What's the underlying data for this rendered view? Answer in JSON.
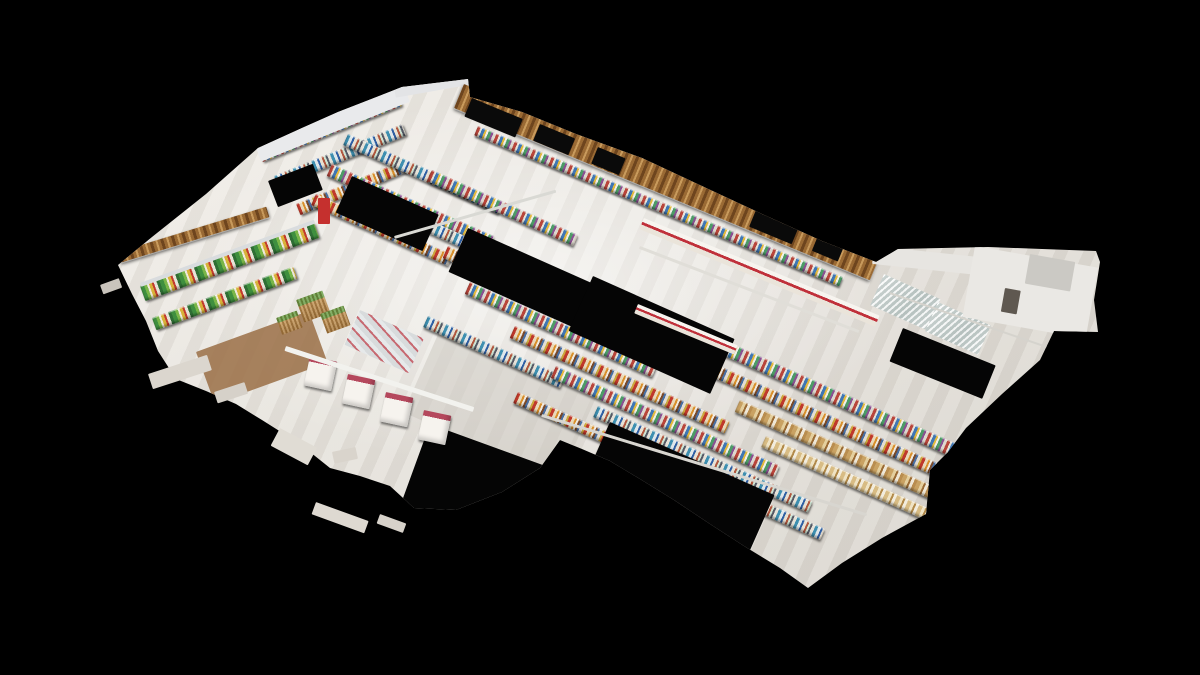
{
  "scene": {
    "palette": {
      "background": "#000000",
      "floor_hi": "#efece6",
      "floor_lo": "#dbd7d0",
      "wood_dark": "#6e451e",
      "wood_mid": "#9a6a34",
      "wood_light": "#c89a5c",
      "accent_red": "#c0303a",
      "stripe_magenta": "#b5485d",
      "void_black": "#050505",
      "wall_white": "#e9eaec",
      "rail_white": "#f2f2ee"
    },
    "outline": [
      [
        118,
        265
      ],
      [
        152,
        237
      ],
      [
        206,
        194
      ],
      [
        258,
        148
      ],
      [
        302,
        128
      ],
      [
        338,
        112
      ],
      [
        402,
        87
      ],
      [
        468,
        79
      ],
      [
        470,
        97
      ],
      [
        522,
        112
      ],
      [
        576,
        134
      ],
      [
        642,
        158
      ],
      [
        704,
        187
      ],
      [
        762,
        214
      ],
      [
        822,
        241
      ],
      [
        876,
        262
      ],
      [
        898,
        249
      ],
      [
        942,
        248
      ],
      [
        988,
        247
      ],
      [
        1042,
        249
      ],
      [
        1096,
        251
      ],
      [
        1100,
        262
      ],
      [
        1094,
        300
      ],
      [
        1098,
        332
      ],
      [
        1054,
        331
      ],
      [
        1040,
        360
      ],
      [
        1002,
        394
      ],
      [
        966,
        428
      ],
      [
        948,
        452
      ],
      [
        930,
        470
      ],
      [
        926,
        514
      ],
      [
        882,
        538
      ],
      [
        842,
        563
      ],
      [
        808,
        588
      ],
      [
        780,
        568
      ],
      [
        744,
        546
      ],
      [
        710,
        524
      ],
      [
        674,
        500
      ],
      [
        640,
        479
      ],
      [
        610,
        461
      ],
      [
        582,
        449
      ],
      [
        560,
        440
      ],
      [
        540,
        468
      ],
      [
        502,
        492
      ],
      [
        456,
        510
      ],
      [
        414,
        508
      ],
      [
        390,
        486
      ],
      [
        360,
        476
      ],
      [
        330,
        468
      ],
      [
        300,
        444
      ],
      [
        262,
        420
      ],
      [
        236,
        404
      ],
      [
        206,
        391
      ],
      [
        176,
        379
      ],
      [
        158,
        351
      ],
      [
        146,
        321
      ],
      [
        132,
        294
      ]
    ],
    "objects": [
      {
        "name": "wood-floor-patch",
        "color": "#9a6f45",
        "x": 196,
        "y": 352,
        "w": 120,
        "h": 55,
        "rot": -20,
        "op": 0.85
      },
      {
        "name": "floor-shadow",
        "color": "#c9c5be",
        "x": 440,
        "y": 330,
        "w": 170,
        "h": 90,
        "rot": 24,
        "op": 0.5
      },
      {
        "name": "wall-shelf-row",
        "tex": "a",
        "x": 258,
        "y": 150,
        "w": 150,
        "h": 13,
        "rot": -22
      },
      {
        "name": "wall-shelf-row",
        "tex": "b",
        "x": 274,
        "y": 176,
        "w": 138,
        "h": 12,
        "rot": -22
      },
      {
        "name": "wall-shelf-row",
        "tex": "c",
        "x": 296,
        "y": 204,
        "w": 115,
        "h": 12,
        "rot": -22
      },
      {
        "name": "gondola-aisle",
        "tex": "b",
        "x": 348,
        "y": 134,
        "w": 170,
        "h": 12,
        "rot": 24
      },
      {
        "name": "gondola-aisle",
        "tex": "a",
        "x": 332,
        "y": 164,
        "w": 178,
        "h": 13,
        "rot": 24
      },
      {
        "name": "gondola-aisle",
        "tex": "c",
        "x": 316,
        "y": 194,
        "w": 150,
        "h": 12,
        "rot": 24
      },
      {
        "name": "gondola-aisle",
        "tex": "a",
        "x": 432,
        "y": 170,
        "w": 160,
        "h": 12,
        "rot": 24
      },
      {
        "name": "gondola-aisle",
        "tex": "b",
        "x": 402,
        "y": 208,
        "w": 125,
        "h": 12,
        "rot": 24
      },
      {
        "name": "gondola-aisle",
        "tex": "c",
        "x": 448,
        "y": 246,
        "w": 195,
        "h": 13,
        "rot": 24
      },
      {
        "name": "gondola-aisle",
        "tex": "a",
        "x": 470,
        "y": 282,
        "w": 205,
        "h": 13,
        "rot": 24
      },
      {
        "name": "gondola-aisle",
        "tex": "b",
        "x": 428,
        "y": 316,
        "w": 150,
        "h": 12,
        "rot": 24
      },
      {
        "name": "gondola-aisle",
        "tex": "c",
        "x": 515,
        "y": 326,
        "w": 235,
        "h": 13,
        "rot": 24
      },
      {
        "name": "gondola-aisle",
        "tex": "a",
        "x": 556,
        "y": 366,
        "w": 245,
        "h": 13,
        "rot": 24
      },
      {
        "name": "gondola-aisle",
        "tex": "b",
        "x": 598,
        "y": 406,
        "w": 235,
        "h": 12,
        "rot": 24
      },
      {
        "name": "gondola-aisle",
        "tex": "c",
        "x": 518,
        "y": 392,
        "w": 120,
        "h": 12,
        "rot": 24
      },
      {
        "name": "front-wall-shelf",
        "tex": "a",
        "x": 478,
        "y": 126,
        "w": 395,
        "h": 10,
        "rot": 22.5
      },
      {
        "name": "long-aisle",
        "tex": "a",
        "x": 692,
        "y": 326,
        "w": 325,
        "h": 14,
        "rot": 24
      },
      {
        "name": "long-aisle",
        "tex": "c",
        "x": 715,
        "y": 364,
        "w": 305,
        "h": 13,
        "rot": 24
      },
      {
        "name": "bakery-aisle",
        "tex": "tan",
        "x": 740,
        "y": 400,
        "w": 285,
        "h": 13,
        "rot": 24
      },
      {
        "name": "bakery-aisle",
        "tex": "tan2",
        "x": 766,
        "y": 436,
        "w": 245,
        "h": 12,
        "rot": 24
      },
      {
        "name": "long-aisle",
        "tex": "b",
        "x": 688,
        "y": 468,
        "w": 150,
        "h": 12,
        "rot": 24
      },
      {
        "name": "freezer-void",
        "color": "#050505",
        "x": 352,
        "y": 176,
        "w": 95,
        "h": 40,
        "rot": 24
      },
      {
        "name": "freezer-void",
        "color": "#050505",
        "x": 468,
        "y": 228,
        "w": 140,
        "h": 48,
        "rot": 24
      },
      {
        "name": "freezer-void",
        "color": "#050505",
        "x": 593,
        "y": 276,
        "w": 155,
        "h": 60,
        "rot": 24
      },
      {
        "name": "freezer-void",
        "color": "#050505",
        "x": 903,
        "y": 328,
        "w": 100,
        "h": 36,
        "rot": 22
      },
      {
        "name": "freezer-void",
        "color": "#050505",
        "x": 610,
        "y": 422,
        "w": 180,
        "h": 62,
        "rot": 24
      },
      {
        "name": "freezer-void",
        "color": "#050505",
        "x": 430,
        "y": 424,
        "w": 145,
        "h": 86,
        "rot": 20
      },
      {
        "name": "freezer-void",
        "color": "#050505",
        "x": 268,
        "y": 181,
        "w": 48,
        "h": 28,
        "rot": -21
      },
      {
        "name": "produce-case",
        "tex": "produce",
        "x": 140,
        "y": 286,
        "w": 185,
        "h": 16,
        "rot": -20
      },
      {
        "name": "produce-case-rail",
        "color": "#d9dcde",
        "x": 140,
        "y": 283,
        "w": 185,
        "h": 4,
        "rot": -20
      },
      {
        "name": "produce-case",
        "tex": "produce",
        "x": 152,
        "y": 318,
        "w": 150,
        "h": 13,
        "rot": -20
      },
      {
        "name": "produce-bin",
        "tex": "basket",
        "x": 296,
        "y": 300,
        "w": 28,
        "h": 24,
        "rot": -20
      },
      {
        "name": "produce-bin",
        "tex": "basket",
        "x": 320,
        "y": 314,
        "w": 25,
        "h": 21,
        "rot": -20
      },
      {
        "name": "produce-bin",
        "tex": "basket",
        "x": 276,
        "y": 318,
        "w": 22,
        "h": 18,
        "rot": -20
      },
      {
        "name": "meat-table",
        "tex": "meat",
        "x": 360,
        "y": 310,
        "w": 70,
        "h": 38,
        "rot": 24
      },
      {
        "name": "red-display-sign",
        "color": "#c5302e",
        "x": 318,
        "y": 198,
        "w": 12,
        "h": 26,
        "rot": 0
      },
      {
        "name": "service-counter",
        "tex": "counter",
        "x": 644,
        "y": 218,
        "w": 255,
        "h": 12,
        "rot": 22.5
      },
      {
        "name": "service-counter",
        "tex": "counter",
        "x": 638,
        "y": 304,
        "w": 108,
        "h": 10,
        "rot": 22.5
      },
      {
        "name": "glass-display-case",
        "tex": "glass",
        "x": 884,
        "y": 274,
        "w": 62,
        "h": 34,
        "rot": 24
      },
      {
        "name": "glass-display-case",
        "tex": "glass",
        "x": 938,
        "y": 302,
        "w": 58,
        "h": 32,
        "rot": 24
      },
      {
        "name": "checkout-counter",
        "tex": "checkout",
        "x": 310,
        "y": 356,
        "w": 28,
        "h": 30,
        "rot": 12
      },
      {
        "name": "checkout-counter",
        "tex": "checkout",
        "x": 348,
        "y": 374,
        "w": 28,
        "h": 30,
        "rot": 12
      },
      {
        "name": "checkout-counter",
        "tex": "checkout",
        "x": 386,
        "y": 392,
        "w": 28,
        "h": 30,
        "rot": 12
      },
      {
        "name": "checkout-counter",
        "tex": "checkout",
        "x": 424,
        "y": 410,
        "w": 28,
        "h": 30,
        "rot": 12
      },
      {
        "name": "left-wood-awning",
        "tex": "wood",
        "x": 118,
        "y": 252,
        "w": 155,
        "h": 11,
        "rot": -17
      },
      {
        "name": "back-white-wall",
        "color": "#e9eaec",
        "x": 254,
        "y": 143,
        "w": 160,
        "h": 20,
        "rot": -22
      },
      {
        "name": "white-roof-section",
        "color": "#e3e4e6",
        "x": 392,
        "y": 76,
        "w": 82,
        "h": 22,
        "rot": -10
      },
      {
        "name": "front-wood-wall",
        "tex": "wood",
        "x": 464,
        "y": 84,
        "w": 450,
        "h": 26,
        "rot": 22.5
      },
      {
        "name": "storefront-glass",
        "color": "#0a0a0a",
        "x": 472,
        "y": 98,
        "w": 55,
        "h": 20,
        "rot": 22.5
      },
      {
        "name": "storefront-glass",
        "color": "#0a0a0a",
        "x": 540,
        "y": 124,
        "w": 38,
        "h": 18,
        "rot": 22.5
      },
      {
        "name": "storefront-glass",
        "color": "#0a0a0a",
        "x": 598,
        "y": 147,
        "w": 30,
        "h": 18,
        "rot": 22.5
      },
      {
        "name": "storefront-glass",
        "color": "#0a0a0a",
        "x": 756,
        "y": 210,
        "w": 46,
        "h": 18,
        "rot": 22.5
      },
      {
        "name": "storefront-glass",
        "color": "#0a0a0a",
        "x": 818,
        "y": 236,
        "w": 28,
        "h": 16,
        "rot": 22.5
      },
      {
        "name": "right-white-wall",
        "color": "#e7e5e1",
        "x": 874,
        "y": 246,
        "w": 118,
        "h": 18,
        "rot": 6
      },
      {
        "name": "extension-room",
        "color": "#eae8e4",
        "x": 975,
        "y": 246,
        "w": 125,
        "h": 72,
        "rot": 10
      },
      {
        "name": "extension-detail",
        "color": "#cbc9c4",
        "x": 1030,
        "y": 254,
        "w": 46,
        "h": 30,
        "rot": 10
      },
      {
        "name": "extension-doorway",
        "color": "#5f5850",
        "x": 1005,
        "y": 288,
        "w": 16,
        "h": 24,
        "rot": 10
      },
      {
        "name": "ceiling-rail",
        "color": "#f2f2ee",
        "x": 286,
        "y": 346,
        "w": 198,
        "h": 5,
        "rot": 18
      },
      {
        "name": "ceiling-rail",
        "color": "#d9d9d4",
        "x": 394,
        "y": 236,
        "w": 168,
        "h": 3,
        "rot": -16
      },
      {
        "name": "ceiling-rail",
        "color": "#d8d6d0",
        "x": 542,
        "y": 414,
        "w": 340,
        "h": 3,
        "rot": 17
      },
      {
        "name": "ceiling-rail",
        "color": "#e0ded8",
        "x": 640,
        "y": 246,
        "w": 235,
        "h": 3,
        "rot": 21
      },
      {
        "name": "ceiling-rail",
        "color": "#d5d3cd",
        "x": 890,
        "y": 292,
        "w": 170,
        "h": 2,
        "rot": 19
      },
      {
        "name": "floor-fragment",
        "color": "#dbd6ce",
        "x": 148,
        "y": 374,
        "w": 62,
        "h": 16,
        "rot": -18,
        "layer": "stage"
      },
      {
        "name": "floor-fragment",
        "color": "#d6d1c9",
        "x": 214,
        "y": 392,
        "w": 32,
        "h": 12,
        "rot": -18,
        "layer": "stage"
      },
      {
        "name": "floor-fragment",
        "color": "#e0dcd4",
        "x": 280,
        "y": 428,
        "w": 42,
        "h": 20,
        "rot": 28,
        "layer": "stage"
      },
      {
        "name": "floor-fragment",
        "color": "#d9d4cc",
        "x": 332,
        "y": 452,
        "w": 24,
        "h": 12,
        "rot": -12,
        "layer": "stage"
      },
      {
        "name": "floor-fragment",
        "color": "#ded9d1",
        "x": 316,
        "y": 502,
        "w": 56,
        "h": 13,
        "rot": 20,
        "layer": "stage"
      },
      {
        "name": "floor-fragment",
        "color": "#d7d2ca",
        "x": 380,
        "y": 514,
        "w": 28,
        "h": 10,
        "rot": 20,
        "layer": "stage"
      },
      {
        "name": "floor-fragment",
        "color": "#c9c4bc",
        "x": 100,
        "y": 285,
        "w": 20,
        "h": 10,
        "rot": -20,
        "layer": "stage"
      }
    ]
  }
}
